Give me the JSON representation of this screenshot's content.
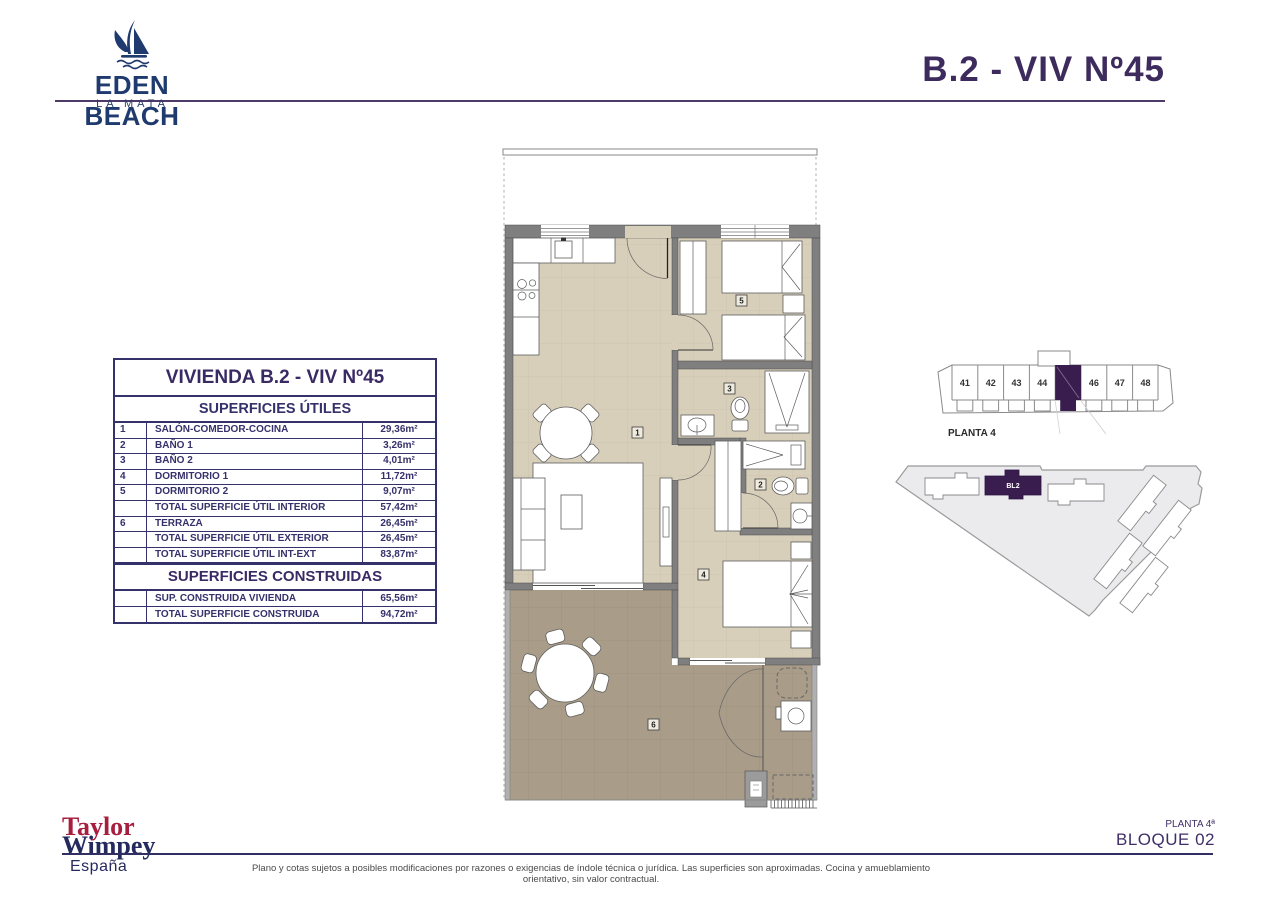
{
  "header": {
    "logo_name": "EDEN BEACH",
    "logo_subtitle": "LA MATA",
    "title": "B.2 - VIV Nº45"
  },
  "tables": {
    "useful": {
      "title": "VIVIENDA B.2 - VIV Nº45",
      "subtitle": "SUPERFICIES ÚTILES",
      "rows": [
        {
          "num": "1",
          "label": "SALÓN-COMEDOR-COCINA",
          "value": "29,36m²"
        },
        {
          "num": "2",
          "label": "BAÑO 1",
          "value": "3,26m²"
        },
        {
          "num": "3",
          "label": "BAÑO 2",
          "value": "4,01m²"
        },
        {
          "num": "4",
          "label": "DORMITORIO 1",
          "value": "11,72m²"
        },
        {
          "num": "5",
          "label": "DORMITORIO 2",
          "value": "9,07m²"
        },
        {
          "num": "",
          "label": "TOTAL SUPERFICIE ÚTIL INTERIOR",
          "value": "57,42m²"
        },
        {
          "num": "6",
          "label": "TERRAZA",
          "value": "26,45m²"
        },
        {
          "num": "",
          "label": "TOTAL SUPERFICIE ÚTIL EXTERIOR",
          "value": "26,45m²"
        },
        {
          "num": "",
          "label": "TOTAL SUPERFICIE ÚTIL INT-EXT",
          "value": "83,87m²"
        }
      ]
    },
    "built": {
      "title": "SUPERFICIES CONSTRUIDAS",
      "rows": [
        {
          "num": "",
          "label": "SUP. CONSTRUIDA VIVIENDA",
          "value": "65,56m²"
        },
        {
          "num": "",
          "label": "TOTAL SUPERFICIE CONSTRUIDA",
          "value": "94,72m²"
        }
      ]
    }
  },
  "floor_plan": {
    "room_labels": [
      "1",
      "2",
      "3",
      "4",
      "5",
      "6"
    ]
  },
  "block_diagram": {
    "visible_units": [
      "41",
      "42",
      "43",
      "44",
      "46",
      "47",
      "48"
    ],
    "highlighted_unit": "45",
    "caption": "PLANTA 4"
  },
  "site_plan": {
    "block_label": "BL2"
  },
  "footer": {
    "brand_top": "Taylor",
    "brand_bottom": "Wimpey",
    "brand_country": "España",
    "disclaimer": "Plano y cotas sujetos a posibles modificaciones por razones o exigencias de índole técnica o jurídica. Las superficies son aproximadas. Cocina y amueblamiento orientativo, sin valor contractual.",
    "floor_label": "PLANTA 4ª",
    "block_label": "BLOQUE 02"
  },
  "colors": {
    "accent_purple": "#3d2b5e",
    "highlight_purple": "#3a1d4f",
    "brand_navy": "#1e3a6e",
    "brand_red": "#a81e3f",
    "interior_floor": "#d8cfba",
    "terrace_floor": "#a99c88",
    "wall_gray": "#7f7f7f"
  }
}
